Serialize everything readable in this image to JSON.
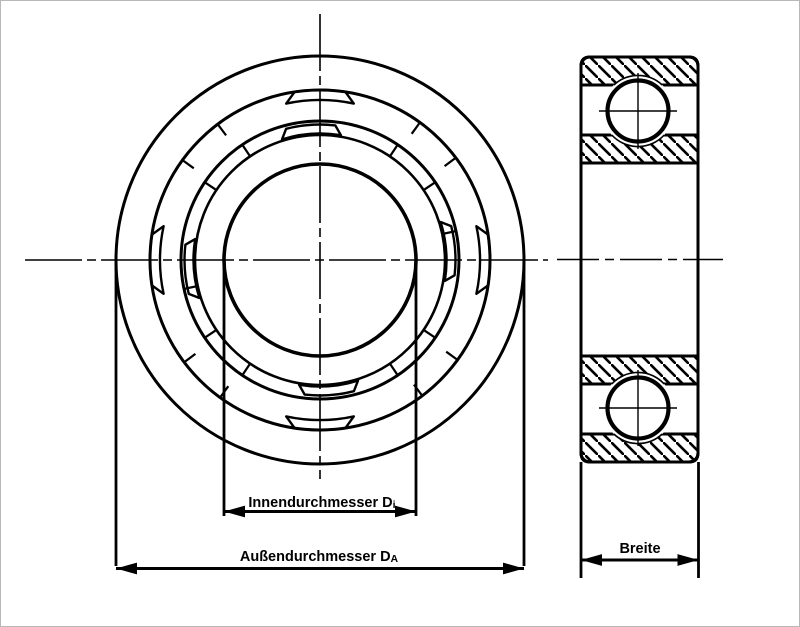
{
  "labels": {
    "inner_diameter": {
      "text": "Innendurchmesser D",
      "sub": "i"
    },
    "outer_diameter": {
      "text": "Außendurchmesser D",
      "sub": "A"
    },
    "width": {
      "text": "Breite"
    }
  },
  "colors": {
    "line": "#000000",
    "background": "#ffffff",
    "border": "#b8b8b8"
  },
  "front_view": {
    "center": {
      "x": 320,
      "y": 260
    },
    "circles": [
      {
        "name": "outer-ring-outer-edge",
        "r": 204,
        "stroke_width": 3
      },
      {
        "name": "outer-ring-inner-edge",
        "r": 170,
        "stroke_width": 3
      },
      {
        "name": "cage-outer-edge",
        "r": 139,
        "stroke_width": 3
      },
      {
        "name": "inner-ring-outer-edge",
        "r": 125,
        "stroke_width": 2.6
      },
      {
        "name": "bore-edge",
        "r": 96,
        "stroke_width": 3.6
      }
    ],
    "outer_pockets": {
      "angles": [
        90,
        180,
        270,
        0
      ],
      "r_outer": 170,
      "half_angle_outer": 8.6,
      "r_inner": 160,
      "half_angle_inner": 12.2
    },
    "inner_pockets": {
      "angles": [
        94,
        184,
        274,
        4
      ],
      "r_outer": 135.5,
      "half_angle_outer": 10.5,
      "r_inner": 126.5,
      "half_angle_inner": 13.5
    },
    "outer_ticks": {
      "angles": [
        37,
        54,
        127,
        144,
        217,
        234,
        307,
        324
      ],
      "r1": 170,
      "r2": 156
    },
    "inner_ticks": {
      "angles": [
        12,
        34,
        56,
        124,
        146,
        192,
        214,
        236,
        304,
        326
      ],
      "r1": 139,
      "r2": 125
    },
    "centerline_vertical": {
      "x": 320,
      "y1": 14,
      "y2": 479
    },
    "centerline_horizontal": {
      "y": 260,
      "x1": 25,
      "x2": 548
    }
  },
  "side_view": {
    "rect": {
      "x": 581,
      "y": 57,
      "width": 117,
      "height": 405,
      "corner_radius": 9
    },
    "ball_radius": 30.5,
    "ball_centers": [
      {
        "x": 638,
        "y": 111
      },
      {
        "x": 638,
        "y": 408
      }
    ],
    "centerline": {
      "y": 259.5,
      "x1": 557,
      "x2": 723
    }
  },
  "dimensions": {
    "inner": {
      "ext_x": [
        224,
        416
      ],
      "ext_y": [
        261,
        516
      ],
      "line_y": 511.5
    },
    "outer": {
      "ext_x": [
        116,
        524
      ],
      "ext_y": [
        261,
        566
      ],
      "line_y": 568.5
    },
    "width": {
      "ext_x": [
        581,
        698.5
      ],
      "ext_y": [
        462,
        578
      ],
      "line_y": 560
    }
  }
}
